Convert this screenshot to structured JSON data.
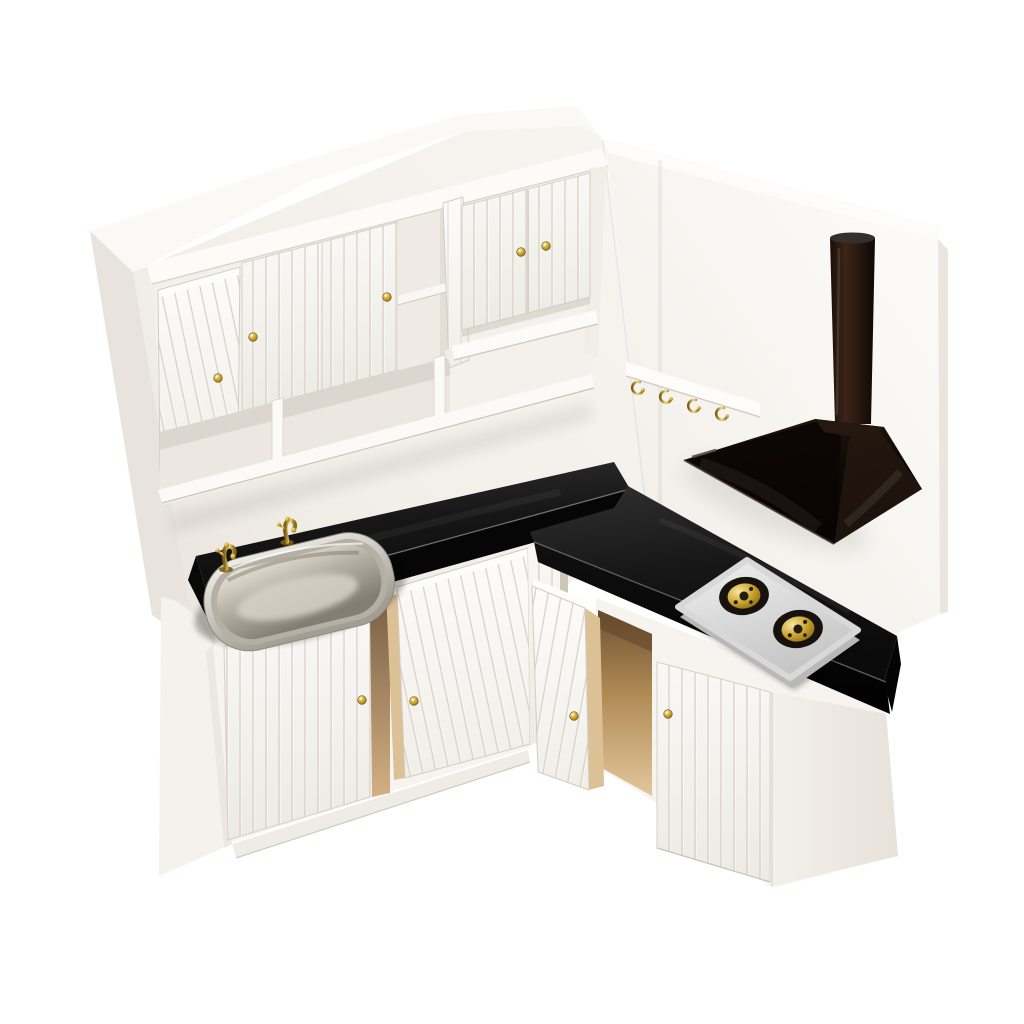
{
  "image": {
    "type": "product-photo",
    "subject": "Miniature dollhouse kitchen corner cabinet set",
    "background": "#ffffff"
  },
  "palette": {
    "white_wood": "#f7f4ef",
    "white_bright": "#fcfbf8",
    "wood_shadow": "#e6e1d9",
    "slat_line": "#d7d1c8",
    "counter_top": "#1c1c1c",
    "counter_front": "#060606",
    "counter_highlight": "#7a7a7a",
    "interior_tan": "#d8b98c",
    "interior_tan_dark": "#7c5d39",
    "tan_edge": "#dcc096",
    "brass": "#c9a227",
    "brass_light": "#f2dd8a",
    "brass_dark": "#7a5c10",
    "steel_light": "#f0ede6",
    "steel_dark": "#837e73",
    "hood_black": "#0d0805",
    "hood_sheen": "#2a1b12",
    "cooktop_silver": "#e0e0e0",
    "cooktop_silver_dark": "#b8b8b8",
    "burner_dark": "#17120d"
  },
  "objects": {
    "scene": {
      "label": "Dollhouse miniature kitchen corner set photo"
    },
    "left_wall": {
      "label": "Left back wall panel"
    },
    "right_wall": {
      "label": "Right side wall panel"
    },
    "upper_cabinet": {
      "label": "Wall-mounted upper cabinet",
      "door_count": 5,
      "open_door_count": 2,
      "open_cubby_count": 3,
      "knob_color": "brass"
    },
    "hook_rail": {
      "label": "Wall rail with hooks",
      "hook_count": 4,
      "hook_color": "brass"
    },
    "range_hood": {
      "label": "Black pyramid range hood with chimney"
    },
    "countertop": {
      "label": "L-shaped black countertop"
    },
    "sink": {
      "label": "Stainless steel sink basin",
      "faucet_count": 2,
      "faucet_color": "brass"
    },
    "cooktop": {
      "label": "Silver two-burner cooktop",
      "burner_count": 2
    },
    "left_base_cabinet": {
      "label": "Sink base cabinet",
      "door_count": 2,
      "open_door_count": 1
    },
    "right_base_cabinet": {
      "label": "Cooktop base cabinet",
      "door_count": 2,
      "open_door_count": 1
    }
  }
}
